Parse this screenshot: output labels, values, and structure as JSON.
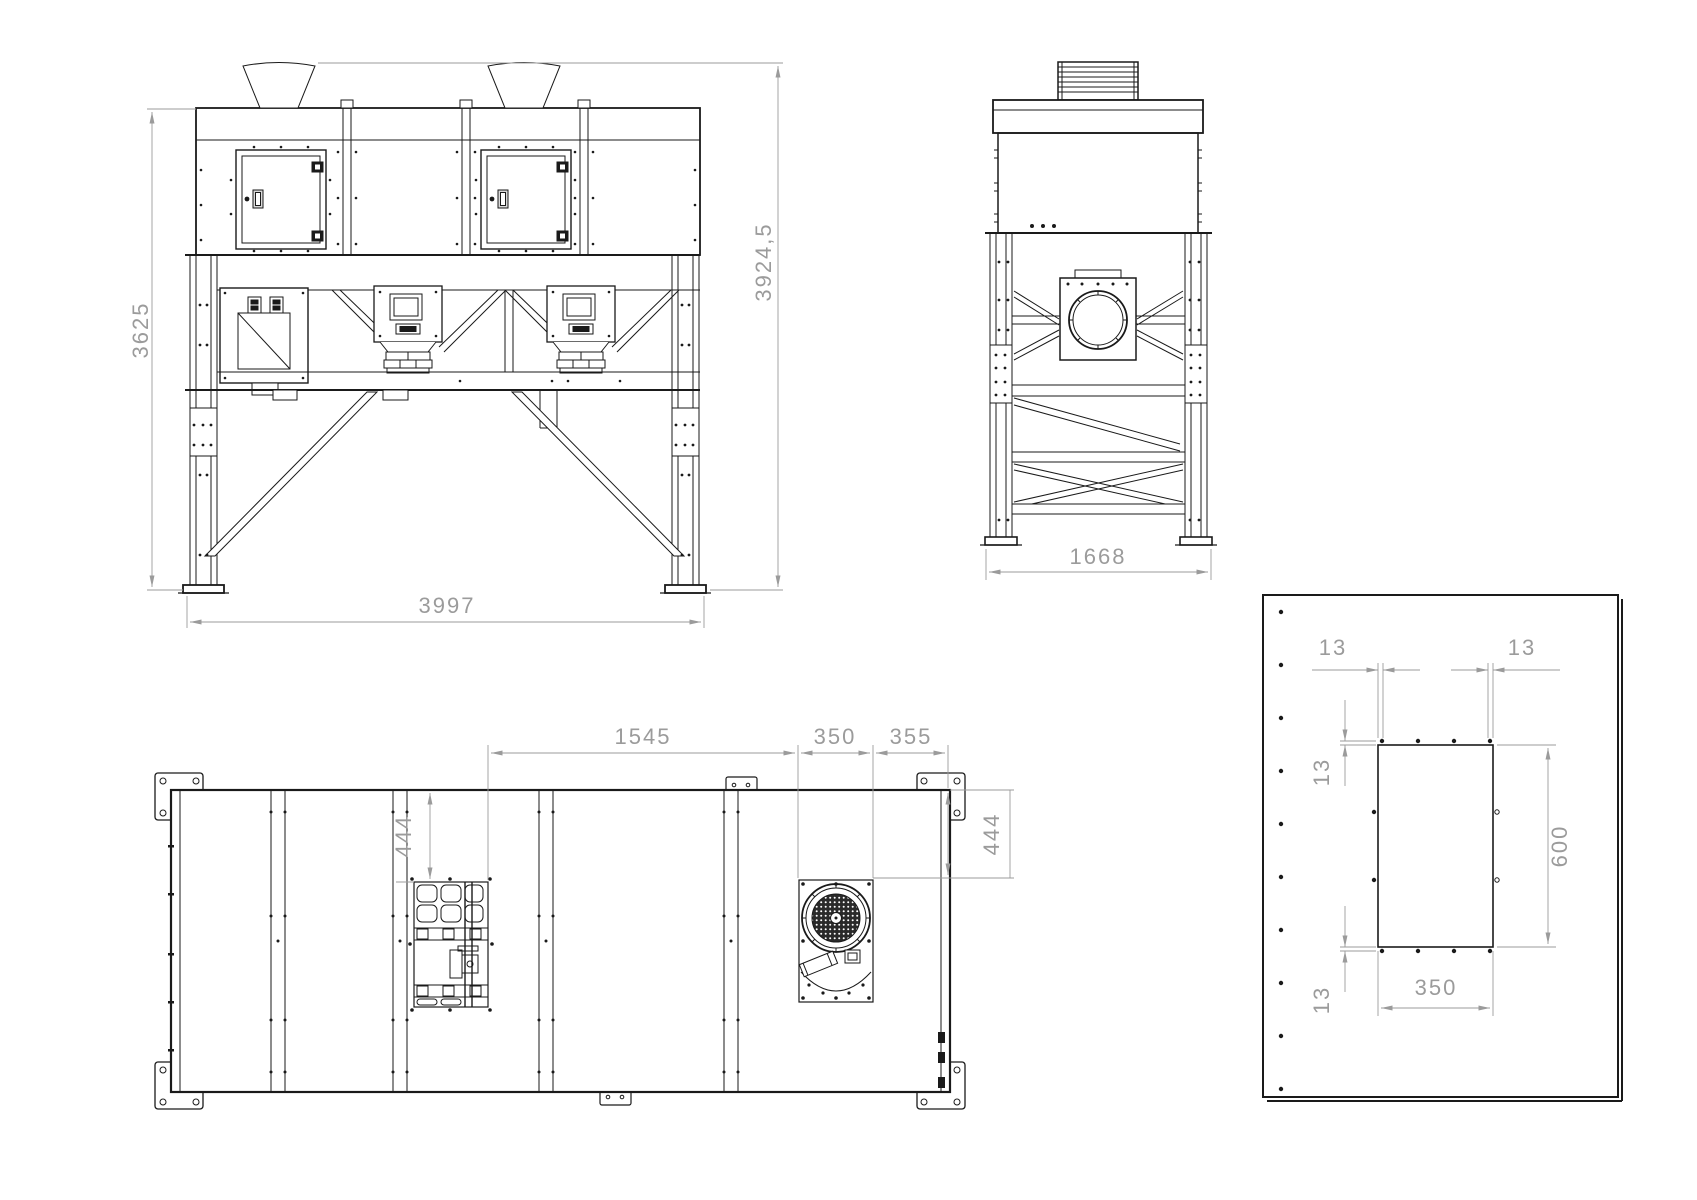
{
  "colors": {
    "background": "#ffffff",
    "line": "#1a1a1a",
    "dimension": "#9b9b9b"
  },
  "views": {
    "front": {
      "dims": {
        "frame_height": "3625",
        "overall_height": "3924,5",
        "overall_width": "3997"
      }
    },
    "side": {
      "dims": {
        "overall_depth": "1668"
      }
    },
    "plan": {
      "dims": {
        "vent_to_fan_span": "1545",
        "fan_plate_width": "350",
        "fan_to_edge": "355",
        "vent_top_offset": "444",
        "fan_top_offset": "444"
      }
    },
    "detail": {
      "dims": {
        "hole_offset_top_left": "13",
        "hole_offset_top_right": "13",
        "hole_offset_upper": "13",
        "hole_offset_lower": "13",
        "opening_height": "600",
        "opening_width": "350"
      }
    }
  }
}
